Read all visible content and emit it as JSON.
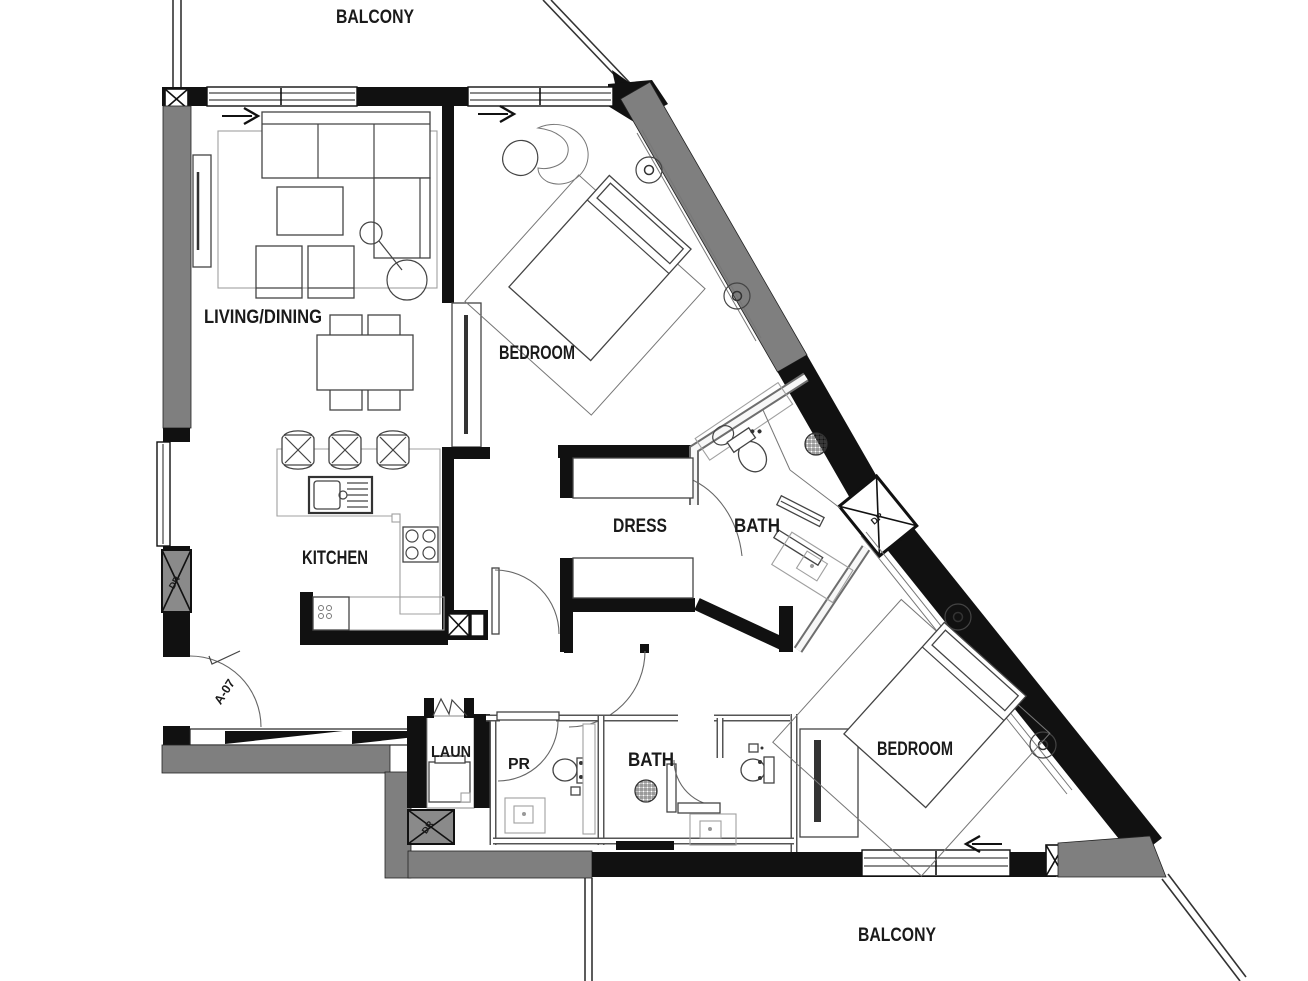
{
  "plan": {
    "type": "apartment-floor-plan",
    "labels": {
      "balcony_top": "BALCONY",
      "living_dining": "LIVING/DINING",
      "bedroom_top": "BEDROOM",
      "dress": "DRESS",
      "bath_master": "BATH",
      "kitchen": "KITCHEN",
      "laundry": "LAUN",
      "powder_room": "PR",
      "bath_second": "BATH",
      "bedroom_bottom": "BEDROOM",
      "balcony_bottom": "BALCONY",
      "entry_door_tag": "A-07",
      "duct_left": "DR",
      "duct_diagonal": "DR",
      "duct_laundry": "DR"
    },
    "colors": {
      "wall": "#111111",
      "structural_wall": "#7f7f7f",
      "partition_light": "#6e6e6e",
      "fixture_line": "#444444",
      "counter_line": "#a0a0a0"
    }
  }
}
